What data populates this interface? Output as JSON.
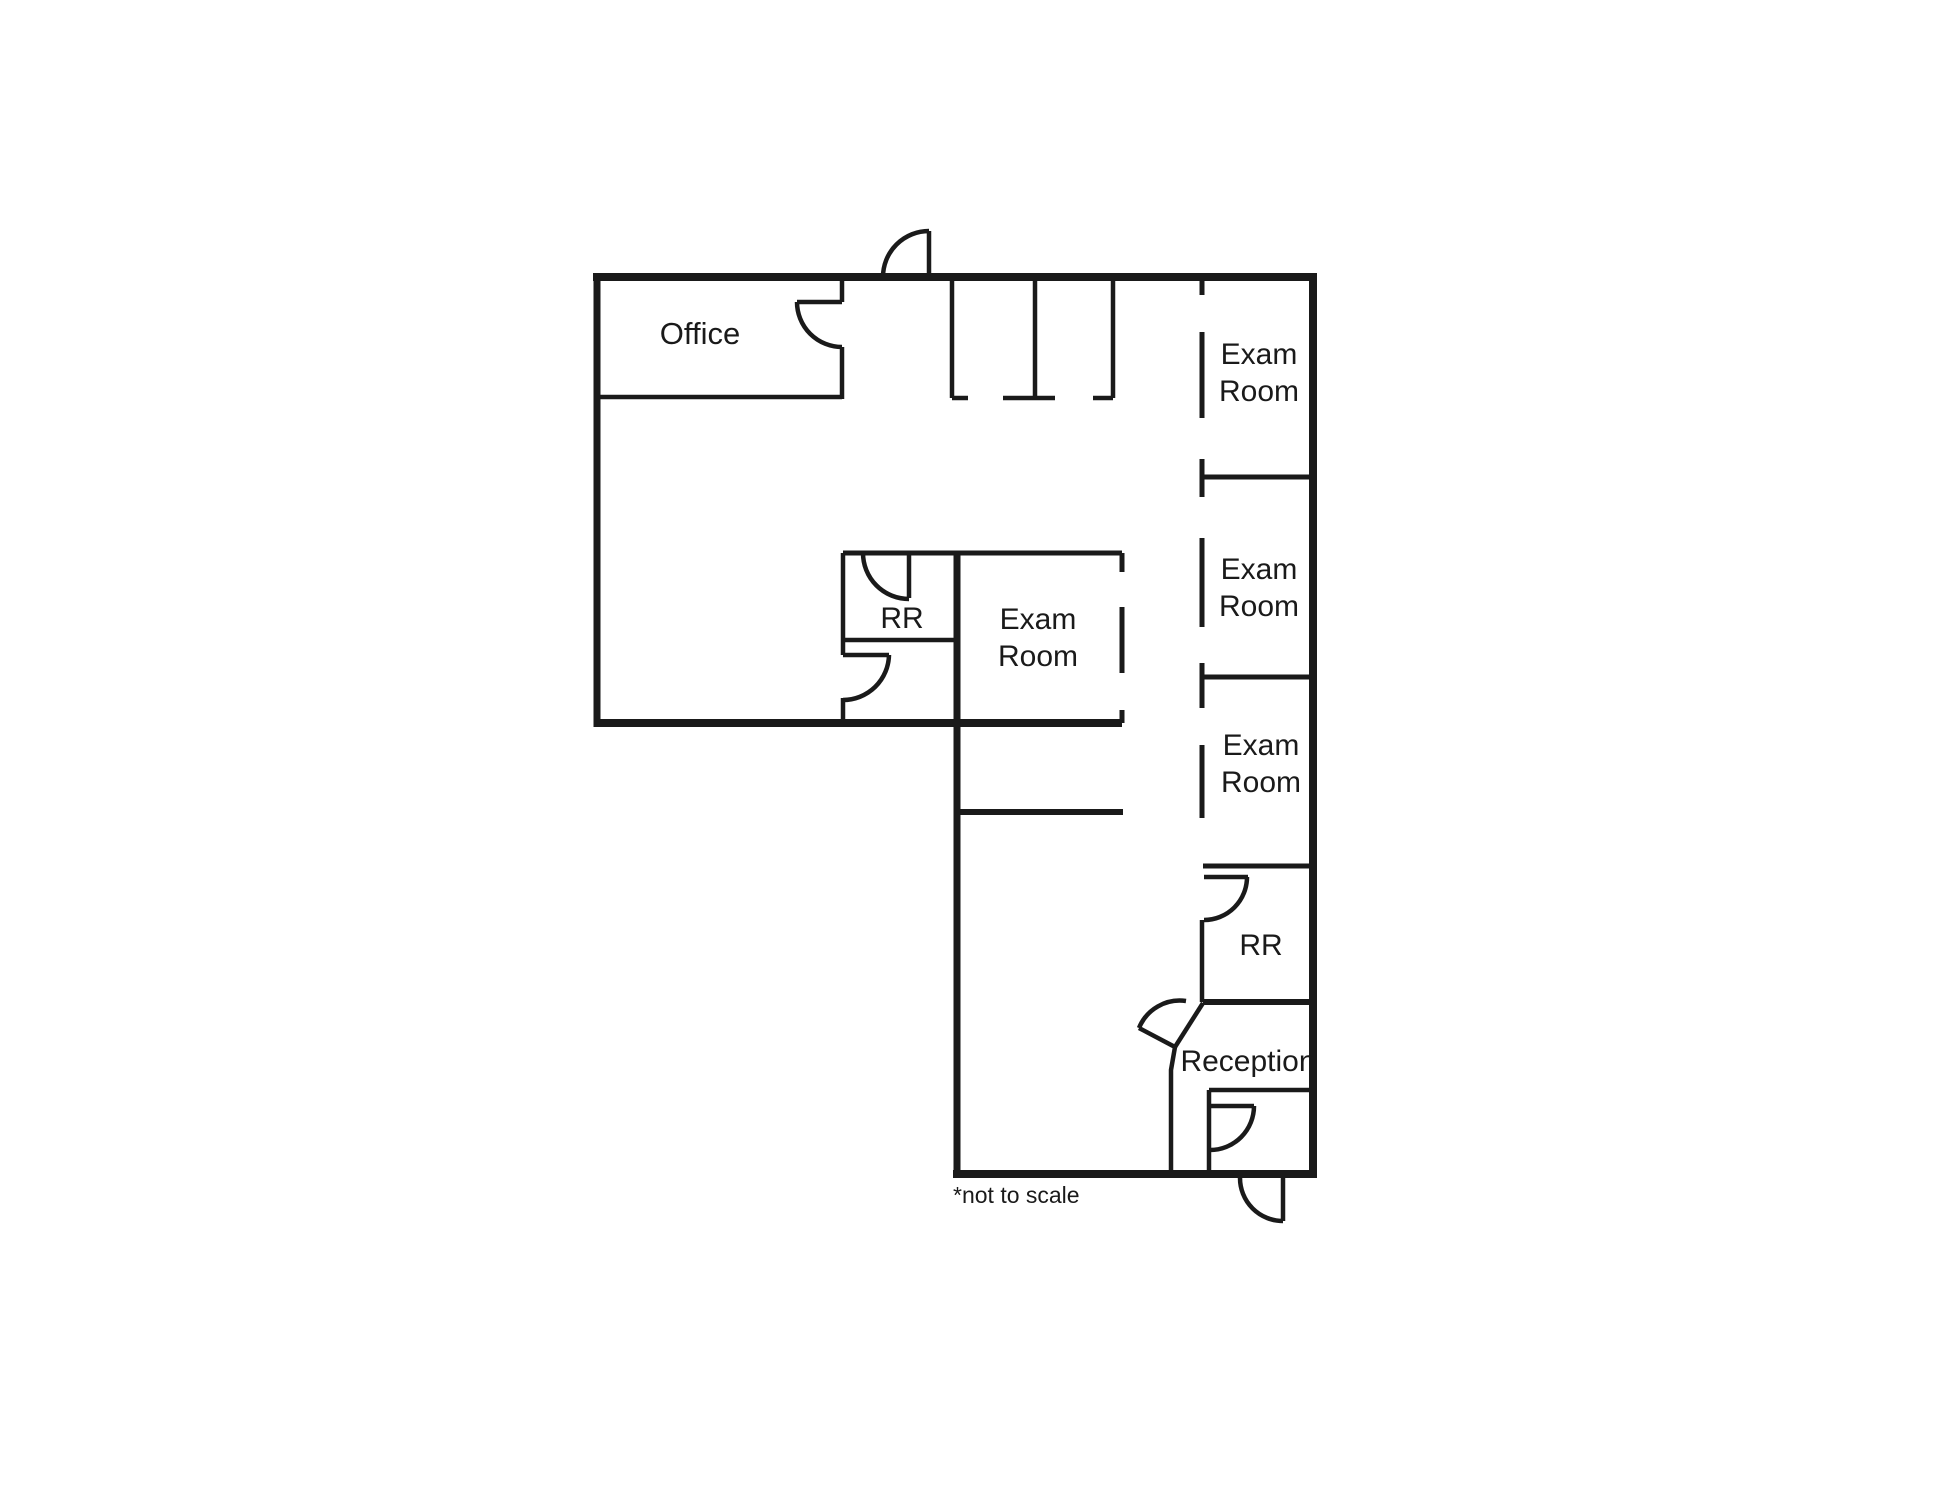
{
  "diagram": {
    "type": "floor-plan",
    "rooms": {
      "office": "Office",
      "exam_room": "Exam Room",
      "restroom": "RR",
      "reception": "Reception"
    },
    "note": "*not to scale",
    "colors": {
      "line": "#1a1a1a",
      "background": "#ffffff",
      "text": "#1a1a1a"
    }
  }
}
